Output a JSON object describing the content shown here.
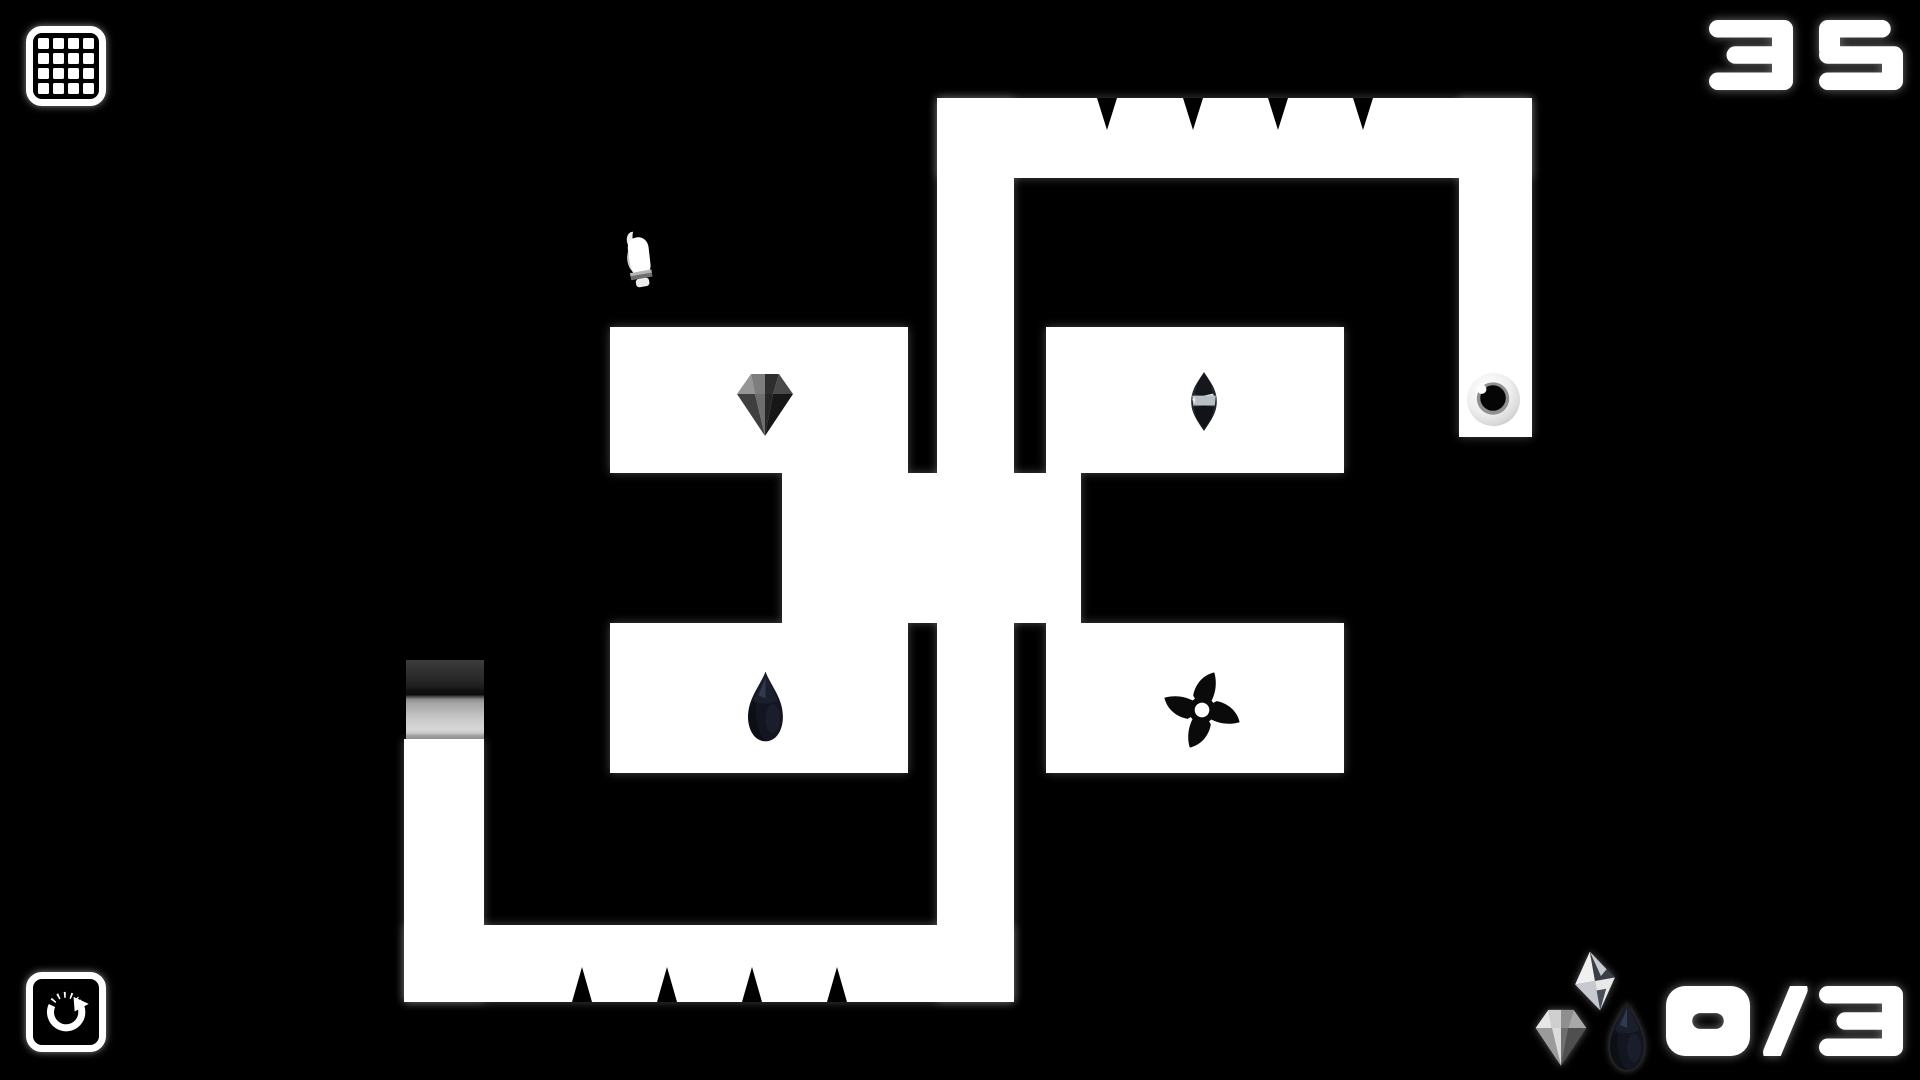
{
  "hud": {
    "menu_button": {
      "icon": "grid-icon",
      "grid_rows": 4,
      "grid_cols": 4
    },
    "restart_button": {
      "icon": "restart-arrow-icon"
    },
    "level_number": "35",
    "gem_counter": {
      "collected": "0",
      "total": "3",
      "display": "0/3",
      "icons": [
        "octahedron-gem-icon",
        "diamond-gem-icon",
        "teardrop-gem-icon"
      ]
    }
  },
  "hud_gems": [
    {
      "type": "octahedron",
      "name": "hud-gem-octahedron",
      "x": 1570,
      "y": 948,
      "w": 50,
      "h": 66
    },
    {
      "type": "diamond_light",
      "name": "hud-gem-diamond",
      "x": 1532,
      "y": 1005,
      "w": 58,
      "h": 64
    },
    {
      "type": "teardrop",
      "name": "hud-gem-teardrop",
      "x": 1606,
      "y": 998,
      "w": 42,
      "h": 76
    }
  ],
  "level": {
    "colors": {
      "background": "#000000",
      "walls": "#ffffff",
      "spikes": "#000000"
    },
    "walls": [
      {
        "name": "top-bar",
        "x": 937,
        "y": 98,
        "w": 595,
        "h": 80
      },
      {
        "name": "center-spine",
        "x": 937,
        "y": 98,
        "w": 77,
        "h": 904
      },
      {
        "name": "goal-column",
        "x": 1459,
        "y": 98,
        "w": 73,
        "h": 339
      },
      {
        "name": "room-upper-left",
        "x": 610,
        "y": 327,
        "w": 298,
        "h": 146
      },
      {
        "name": "room-upper-right",
        "x": 1046,
        "y": 327,
        "w": 298,
        "h": 146
      },
      {
        "name": "center-corridor",
        "x": 782,
        "y": 473,
        "w": 299,
        "h": 150
      },
      {
        "name": "room-lower-left",
        "x": 610,
        "y": 623,
        "w": 298,
        "h": 150
      },
      {
        "name": "room-lower-right",
        "x": 1046,
        "y": 623,
        "w": 298,
        "h": 150
      },
      {
        "name": "left-column",
        "x": 404,
        "y": 739,
        "w": 80,
        "h": 263
      },
      {
        "name": "bottom-bar",
        "x": 404,
        "y": 925,
        "w": 610,
        "h": 77
      }
    ],
    "spike_rows": [
      {
        "spike_name": "ceiling-spike",
        "direction": "down",
        "edge_y": 98,
        "length": 32,
        "half_base": 10,
        "centers_x": [
          1107,
          1193,
          1278,
          1363
        ]
      },
      {
        "spike_name": "floor-spike",
        "direction": "up",
        "edge_y": 1002,
        "length": 35,
        "half_base": 10,
        "centers_x": [
          582,
          667,
          752,
          837
        ]
      }
    ],
    "door": {
      "name": "gradient-door",
      "x": 406,
      "y": 660,
      "w": 78,
      "h": 79
    },
    "items": [
      {
        "type": "hand",
        "name": "player-hand",
        "x": 618,
        "y": 228,
        "w": 42,
        "h": 62
      },
      {
        "type": "diamond",
        "name": "diamond-gem",
        "x": 733,
        "y": 368,
        "w": 64,
        "h": 72
      },
      {
        "type": "marquise",
        "name": "marquise-gem",
        "x": 1186,
        "y": 370,
        "w": 36,
        "h": 63
      },
      {
        "type": "teardrop",
        "name": "teardrop-gem",
        "x": 744,
        "y": 669,
        "w": 43,
        "h": 75
      },
      {
        "type": "shuriken",
        "name": "shuriken-trap",
        "x": 1159,
        "y": 667,
        "w": 86,
        "h": 86
      },
      {
        "type": "goal",
        "name": "goal-orb",
        "x": 1466,
        "y": 372,
        "w": 55,
        "h": 55
      }
    ]
  }
}
